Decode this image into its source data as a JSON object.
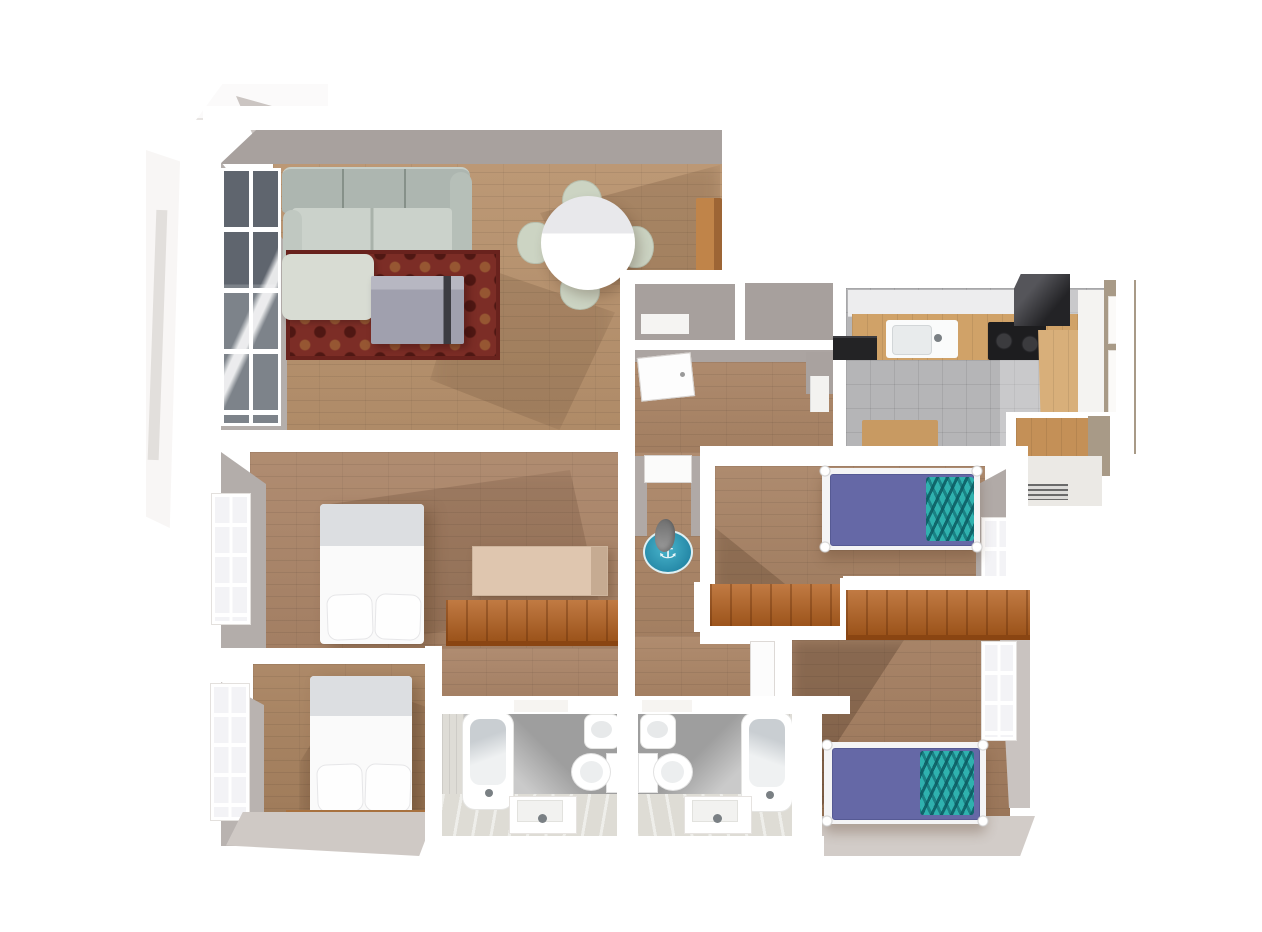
{
  "meta": {
    "description": "3D rendered top-down floor plan of an apartment on a white background",
    "view": "bird's-eye 3D render",
    "background": "#ffffff"
  },
  "palette": {
    "outer_wall_white": "#ffffff",
    "inner_wall_face_gray": "#a8a19e",
    "wood_floor": "#ab8566",
    "wood_floor_dark": "#a27c5e",
    "window_glass_dark": "#6b7178",
    "rug_red": "#7c2d26",
    "rug_pattern_gold": "#ab783c",
    "sofa_gray_green": "#c9d1ca",
    "coffee_table_gray": "#a3a3b0",
    "dining_table_white": "#ffffff",
    "chair_sage": "#ccd4c3",
    "sideboard_wood": "#b97e4b",
    "kitchen_tile_floor": "#b5b5b7",
    "counter_wood": "#d0a268",
    "appliance_black": "#1d1d1f",
    "kitchen_right_wall_tan": "#a89a87",
    "bathroom_tile_wall": "#9e9e9e",
    "bathroom_floor_light": "#dedcd5",
    "fixture_white": "#ffffff",
    "bed_white": "#fafafa",
    "bed_sheet_gray": "#dcdee1",
    "bed_purple": "#6568a6",
    "blanket_teal": "#2fb1ae",
    "wardrobe_orange": "#b5611f",
    "dresser_beige": "#dcc2ab",
    "headboard_wood": "#a8713f",
    "hall_rug_teal": "#35a3bd"
  },
  "icons": {
    "anchor": "⚓"
  },
  "rooms": [
    {
      "name": "living-room",
      "furniture": [
        "corner-sofa",
        "red-patterned-rug",
        "coffee-table",
        "round-dining-table",
        "four-chairs",
        "wood-sideboard",
        "large-window"
      ]
    },
    {
      "name": "entry-hall",
      "furniture": [
        "front-door",
        "double-closet"
      ]
    },
    {
      "name": "kitchen",
      "furniture": [
        "upper-cabinets",
        "wood-countertop",
        "sink",
        "black-cooktop",
        "range-hood",
        "small-wood-table",
        "tiled-floor",
        "side-windows"
      ]
    },
    {
      "name": "hallway",
      "furniture": [
        "round-anchor-rug",
        "standing-figure",
        "doors"
      ]
    },
    {
      "name": "bedroom-master-middle-left",
      "furniture": [
        "double-bed",
        "beige-dresser",
        "orange-wardrobe",
        "window"
      ]
    },
    {
      "name": "bedroom-bottom-left",
      "furniture": [
        "double-bed",
        "wood-headboard-shelf",
        "window"
      ]
    },
    {
      "name": "bedroom-middle-right",
      "furniture": [
        "single-bed-purple",
        "teal-zigzag-blanket",
        "orange-wardrobe",
        "window"
      ]
    },
    {
      "name": "bedroom-bottom-right",
      "furniture": [
        "single-bed-purple",
        "teal-zigzag-blanket",
        "orange-wardrobe",
        "window"
      ]
    },
    {
      "name": "bathroom-left",
      "furniture": [
        "bathtub",
        "bidet",
        "toilet",
        "vanity-sink",
        "gray-tile-wall"
      ]
    },
    {
      "name": "bathroom-right",
      "furniture": [
        "bathtub",
        "bidet",
        "toilet",
        "vanity-sink",
        "gray-tile-wall"
      ]
    }
  ]
}
